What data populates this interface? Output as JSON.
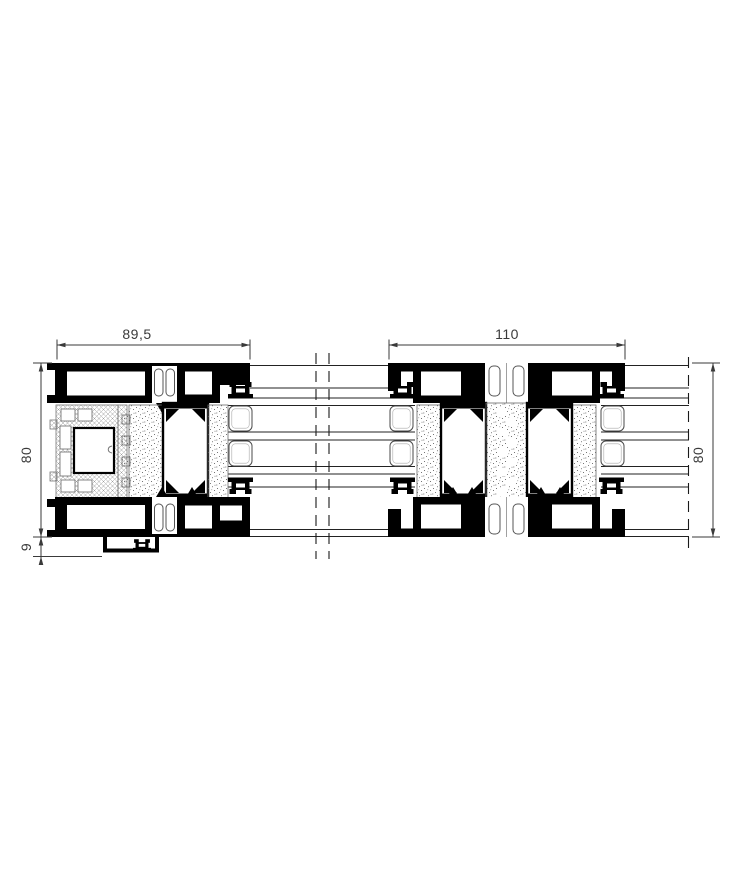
{
  "drawing": {
    "background": "#ffffff",
    "colors": {
      "profile_black": "#000000",
      "dimension_gray": "#3a3a3a",
      "thin_line": "#222222",
      "hatch_gray": "#9b9b9b",
      "stipple_gray": "#555555"
    },
    "left_profile": {
      "width_label": "89,5",
      "height_label": "80",
      "bottom_offset_label": "9"
    },
    "right_profile": {
      "width_label": "110",
      "height_label": "80"
    }
  }
}
